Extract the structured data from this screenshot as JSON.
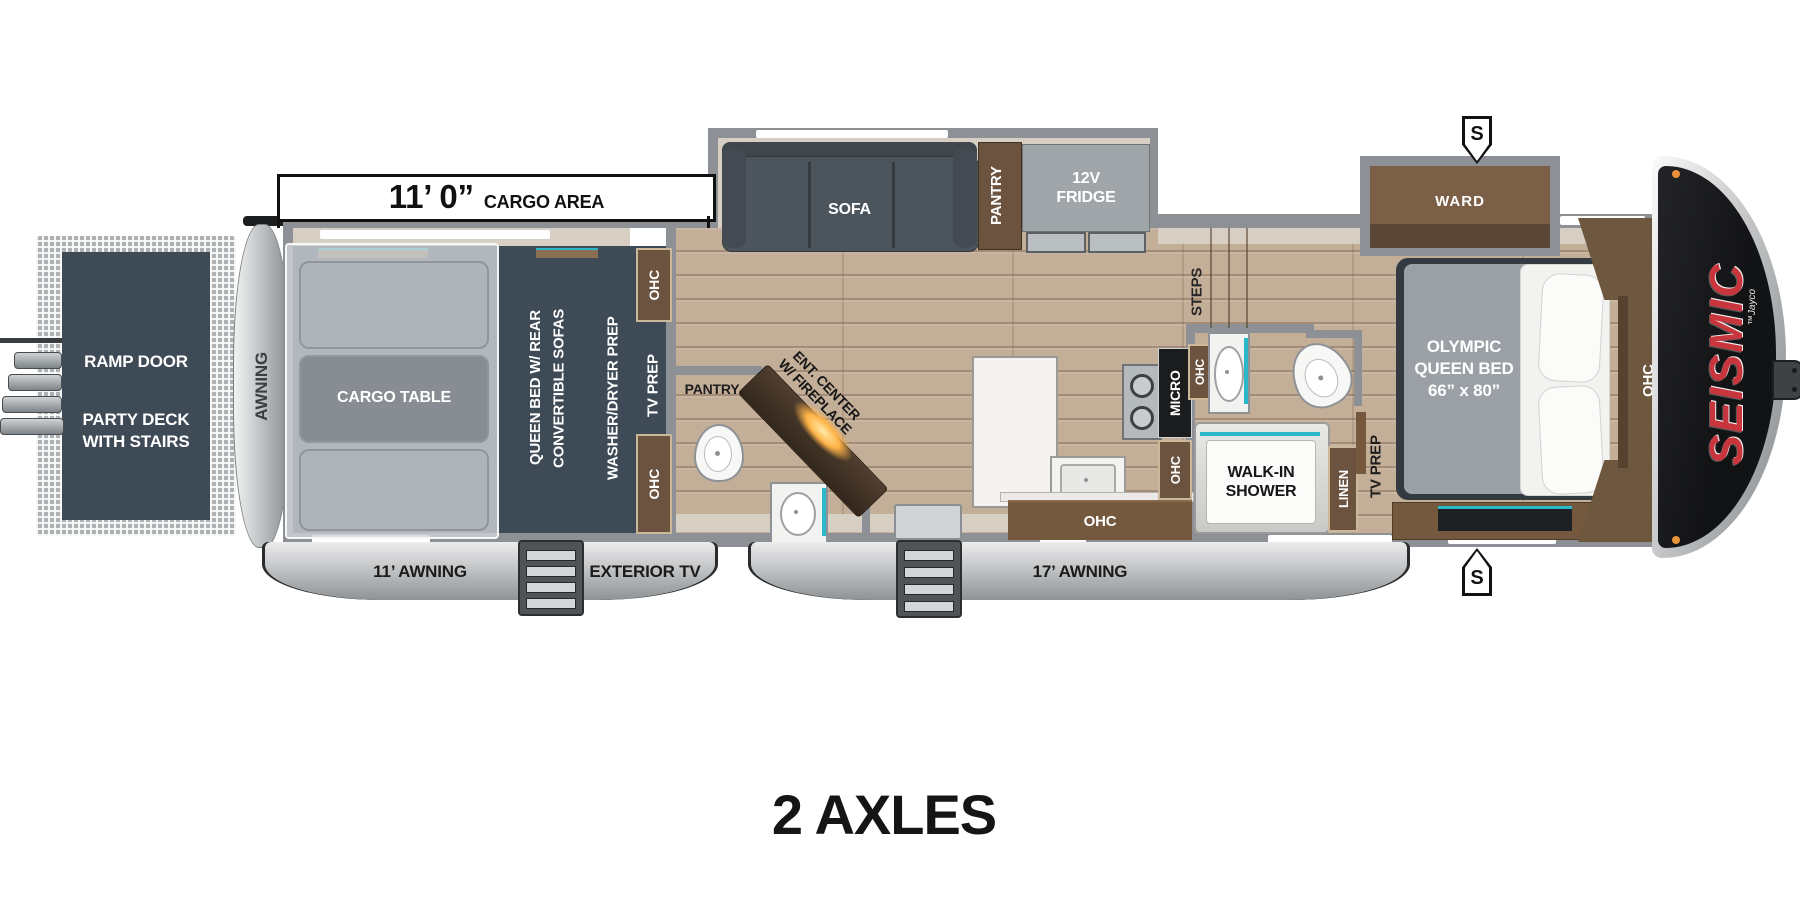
{
  "page": {
    "footer": "2 AXLES"
  },
  "dimension": {
    "value": "11’ 0”",
    "unit_label": "CARGO AREA"
  },
  "badges": {
    "s_top": "S",
    "s_bottom": "S"
  },
  "exterior": {
    "deck": {
      "line1": "RAMP DOOR",
      "line2": "PARTY DECK",
      "line3": "WITH STAIRS"
    },
    "rear_awning": "AWNING",
    "awning_11": "11’ AWNING",
    "exterior_tv": "EXTERIOR TV",
    "awning_17": "17’ AWNING"
  },
  "cargo": {
    "table": "CARGO TABLE",
    "queen_line1": "QUEEN BED W/ REAR",
    "queen_line2": "CONVERTIBLE SOFAS",
    "washer": "WASHER/DRYER PREP",
    "tv_prep": "TV PREP",
    "ohc_top": "OHC",
    "ohc_bottom": "OHC"
  },
  "living": {
    "sofa": "SOFA",
    "pantry": "PANTRY",
    "fridge_line1": "12V",
    "fridge_line2": "FRIDGE",
    "ent_line1": "ENT. CENTER",
    "ent_line2": "W/ FIREPLACE"
  },
  "bath_rear": {
    "pantry": "PANTRY"
  },
  "kitchen": {
    "micro": "MICRO",
    "ohc_side": "OHC",
    "ohc_lower": "OHC",
    "steps": "STEPS"
  },
  "bath_front": {
    "ohc": "OHC",
    "shower_line1": "WALK-IN",
    "shower_line2": "SHOWER",
    "linen": "LINEN"
  },
  "bedroom": {
    "ward": "WARD",
    "tv_prep": "TV PREP",
    "bed_line1": "OLYMPIC",
    "bed_line2": "QUEEN BED",
    "bed_line3": "66” x 80”",
    "ohc": "OHC"
  },
  "brand": {
    "name": "SEISMIC",
    "byline": "™Jayco"
  },
  "colors": {
    "teal": "#2ab7c8",
    "brand_red": "#c8353c",
    "wood": "#c3ae98",
    "slate": "#3e4a56",
    "cabinet": "#74593f",
    "wall": "#8d9196"
  }
}
